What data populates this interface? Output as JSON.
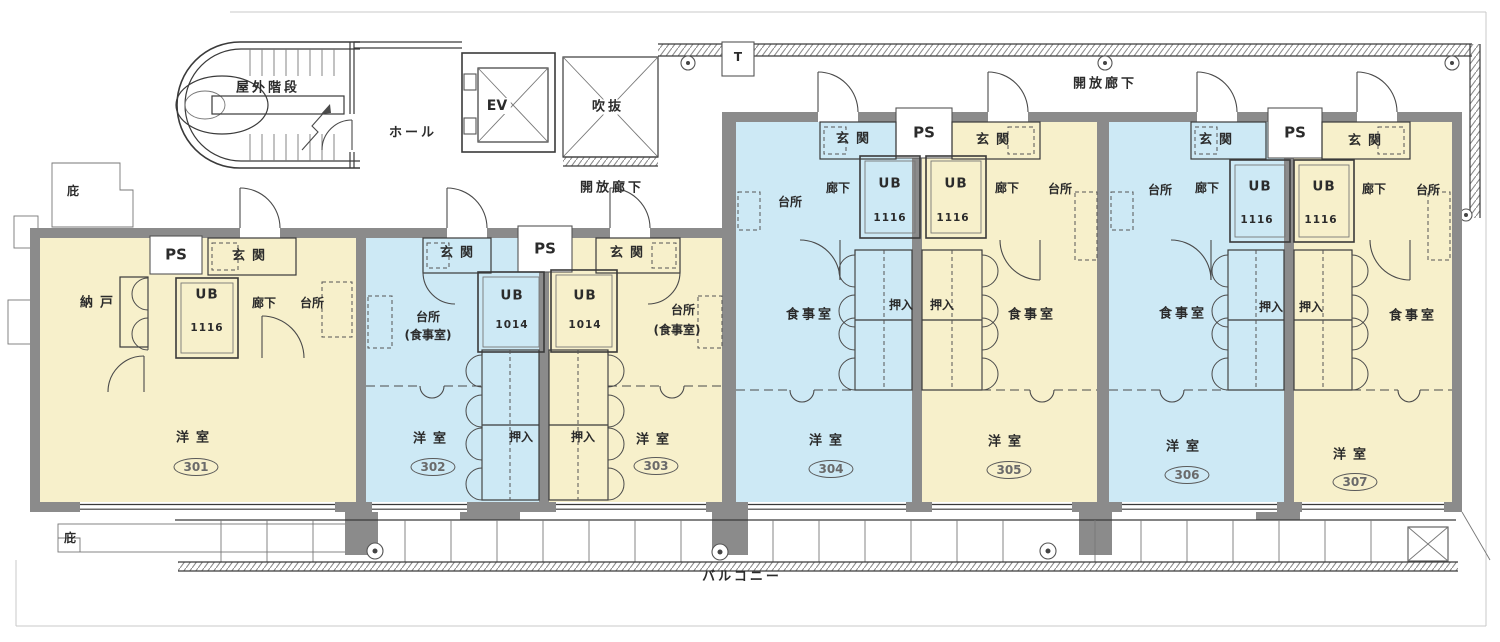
{
  "colors": {
    "unit_warm": "#f7f0cb",
    "unit_cool": "#cde9f5",
    "wall": "#8b8b8b",
    "line": "#3a3a3a",
    "paper": "#ffffff"
  },
  "common": {
    "outdoor_stairs": "屋外階段",
    "hall": "ホール",
    "elevator": "EV",
    "atrium": "吹抜",
    "open_corridor_left": "開放廊下",
    "open_corridor_right": "開放廊下",
    "balcony": "バルコニー",
    "eaves_top": "庇",
    "eaves_bottom": "庇",
    "t_marker": "T",
    "ps": [
      "PS",
      "PS",
      "PS",
      "PS"
    ]
  },
  "units": [
    {
      "number": "301",
      "palette": "warm",
      "western_room": "洋室",
      "storage": "納戸",
      "entrance": "玄関",
      "unit_bath": "UB",
      "unit_bath_size": "1116",
      "hallway": "廊下",
      "kitchen": "台所"
    },
    {
      "number": "302",
      "palette": "cool",
      "western_room": "洋室",
      "entrance": "玄関",
      "unit_bath": "UB",
      "unit_bath_size": "1014",
      "kitchen": "台所",
      "kitchen_note": "(食事室)",
      "closet": "押入"
    },
    {
      "number": "303",
      "palette": "warm",
      "western_room": "洋室",
      "entrance": "玄関",
      "unit_bath": "UB",
      "unit_bath_size": "1014",
      "kitchen": "台所",
      "kitchen_note": "(食事室)",
      "closet": "押入"
    },
    {
      "number": "304",
      "palette": "cool",
      "western_room": "洋室",
      "entrance": "玄関",
      "unit_bath": "UB",
      "unit_bath_size": "1116",
      "hallway": "廊下",
      "kitchen": "台所",
      "dining": "食事室",
      "closet": "押入"
    },
    {
      "number": "305",
      "palette": "warm",
      "western_room": "洋室",
      "entrance": "玄関",
      "unit_bath": "UB",
      "unit_bath_size": "1116",
      "hallway": "廊下",
      "kitchen": "台所",
      "dining": "食事室",
      "closet": "押入"
    },
    {
      "number": "306",
      "palette": "cool",
      "western_room": "洋室",
      "entrance": "玄関",
      "unit_bath": "UB",
      "unit_bath_size": "1116",
      "hallway": "廊下",
      "kitchen": "台所",
      "dining": "食事室",
      "closet": "押入"
    },
    {
      "number": "307",
      "palette": "warm",
      "western_room": "洋室",
      "entrance": "玄関",
      "unit_bath": "UB",
      "unit_bath_size": "1116",
      "hallway": "廊下",
      "kitchen": "台所",
      "dining": "食事室",
      "closet": "押入"
    }
  ]
}
